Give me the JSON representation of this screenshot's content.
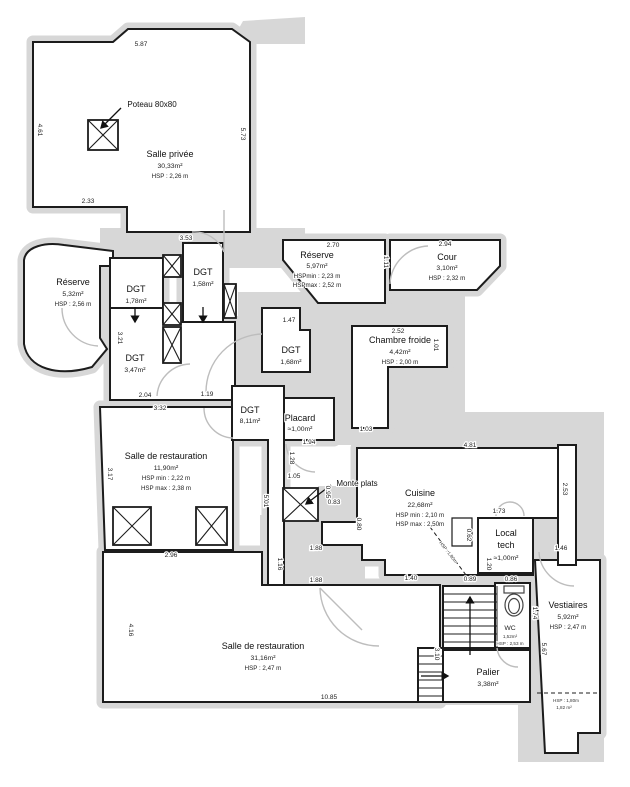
{
  "colors": {
    "wall": "#1c1c1c",
    "poche": "#d7d7d7",
    "door_arc": "#bdbdbd"
  },
  "rooms": {
    "salle_privee": {
      "name": "Salle privée",
      "area": "30,33m²",
      "hsp": "HSP : 2,26 m"
    },
    "poteau": {
      "label": "Poteau 80x80"
    },
    "reserve_ouest": {
      "name": "Réserve",
      "area": "5,32m²",
      "hsp": "HSP : 2,56 m"
    },
    "dgt_a": {
      "name": "DGT",
      "area": "1,78m²"
    },
    "dgt_b": {
      "name": "DGT",
      "area": "1,58m²"
    },
    "dgt_c": {
      "name": "DGT",
      "area": "3,47m²"
    },
    "reserve_nord": {
      "name": "Réserve",
      "area": "5,97m²",
      "hsp_min": "HSPmin : 2,23 m",
      "hsp_max": "HSPmax : 2,52 m"
    },
    "cour": {
      "name": "Cour",
      "area": "3,10m²",
      "hsp": "HSP : 2,32 m"
    },
    "chambre_froide": {
      "name": "Chambre froide",
      "area": "4,42m²",
      "hsp": "HSP : 2,00 m"
    },
    "dgt_d": {
      "name": "DGT",
      "area": "1,68m²"
    },
    "dgt_e": {
      "name": "DGT",
      "area": "8,11m²"
    },
    "placard": {
      "name": "Placard",
      "area": "≈1,00m²"
    },
    "salle_restauration_1": {
      "name": "Salle de restauration",
      "area": "11,90m²",
      "hsp_min": "HSP min : 2,22 m",
      "hsp_max": "HSP max : 2,38 m"
    },
    "monte_plats": {
      "label": "Monte plats"
    },
    "cuisine": {
      "name": "Cuisine",
      "area": "22,68m²",
      "hsp_min": "HSP min : 2,10 m",
      "hsp_max": "HSP max : 2,50m"
    },
    "local_tech": {
      "name_line1": "Local",
      "name_line2": "tech",
      "area": "≈1,00m²"
    },
    "wc": {
      "name": "WC",
      "area": "1,52m²",
      "hsp": "HSP : 2,53 m"
    },
    "vestiaires": {
      "name": "Vestiaires",
      "area": "5,92m²",
      "hsp": "HSP : 2,47 m"
    },
    "salle_restauration_2": {
      "name": "Salle de restauration",
      "area": "31,16m²",
      "hsp": "HSP : 2,47 m"
    },
    "palier": {
      "name": "Palier",
      "area": "3,38m²"
    },
    "niche": {
      "hsp": "HSP : 1,80m",
      "area": "1,82 m²"
    },
    "stair_note": "HSP : 1,80m"
  },
  "dims": {
    "d587": "5.87",
    "d461": "4.61",
    "d573": "5.73",
    "d233": "2.33",
    "d353": "3.53",
    "d270": "2.70",
    "d294": "2.94",
    "d111": "1.11",
    "d147": "1.47",
    "d252": "2.52",
    "d101": "1.01",
    "d103": "1.03",
    "d321": "3.21",
    "d204": "2.04",
    "d119": "1.19",
    "d332": "3.32",
    "d317": "3.17",
    "d296": "2.96",
    "d194": "1.94",
    "d128": "1.28",
    "d105": "1.05",
    "d501": "5.01",
    "d095": "0.95",
    "d083": "0.83",
    "d080": "0.80",
    "d188a": "1.88",
    "d188b": "1.88",
    "d116": "1.16",
    "d140": "1.40",
    "d089": "0.89",
    "d481": "4.81",
    "d253": "2.53",
    "d173": "1.73",
    "d062": "0.62",
    "d120": "1.20",
    "d086": "0.86",
    "d174": "1.74",
    "d146": "1.46",
    "d567": "5.67",
    "d310": "3.10",
    "d416": "4.16",
    "d1085": "10.85"
  }
}
